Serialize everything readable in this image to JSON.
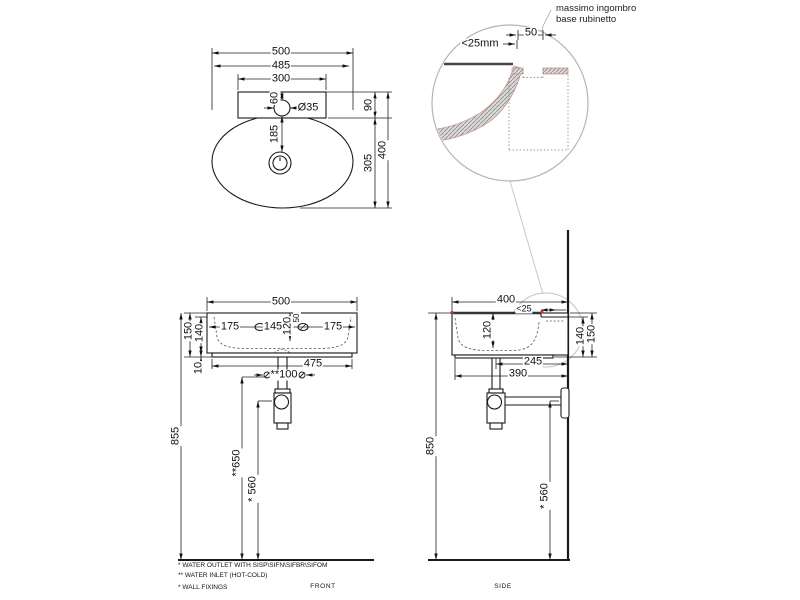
{
  "drawing": {
    "type": "washbasin technical drawing",
    "colors": {
      "line": "#1a1a1a",
      "detail_circle": "#b5b5b5",
      "leader": "#c8c8c8",
      "section_edge": "#cc8880",
      "section_fill": "#d9d9d9",
      "red_marker": "#cc3333"
    }
  },
  "detail": {
    "label1": "massimo ingombro",
    "label2": "base rubinetto",
    "dim_50": "50",
    "dim_25mm": "<25mm"
  },
  "top_view": {
    "w500": "500",
    "w485": "485",
    "w300": "300",
    "d60": "60",
    "hole_dia": "Ø35",
    "d185": "185",
    "d90": "90",
    "d305": "305",
    "d400": "400"
  },
  "front_view": {
    "w500": "500",
    "l175a": "175",
    "l145": "145",
    "d120": "120",
    "d50": "50",
    "l175b": "175",
    "d150": "150",
    "d140": "140",
    "d10": "10",
    "w475": "475",
    "fix100": "**100",
    "h855": "855",
    "h650": "**650",
    "h560": "* 560",
    "label": "FRONT"
  },
  "side_view": {
    "w400": "400",
    "d25": "<25",
    "d120": "120",
    "d140": "140",
    "d150": "150",
    "w245": "245",
    "w390": "390",
    "h850": "850",
    "h560": "* 560",
    "label": "SIDE"
  },
  "notes": [
    "*  WATER OUTLET WITH SISP\\SIFN\\SIFBR\\SIFOM",
    "** WATER INLET  (HOT-COLD)",
    "*  WALL FIXINGS"
  ]
}
